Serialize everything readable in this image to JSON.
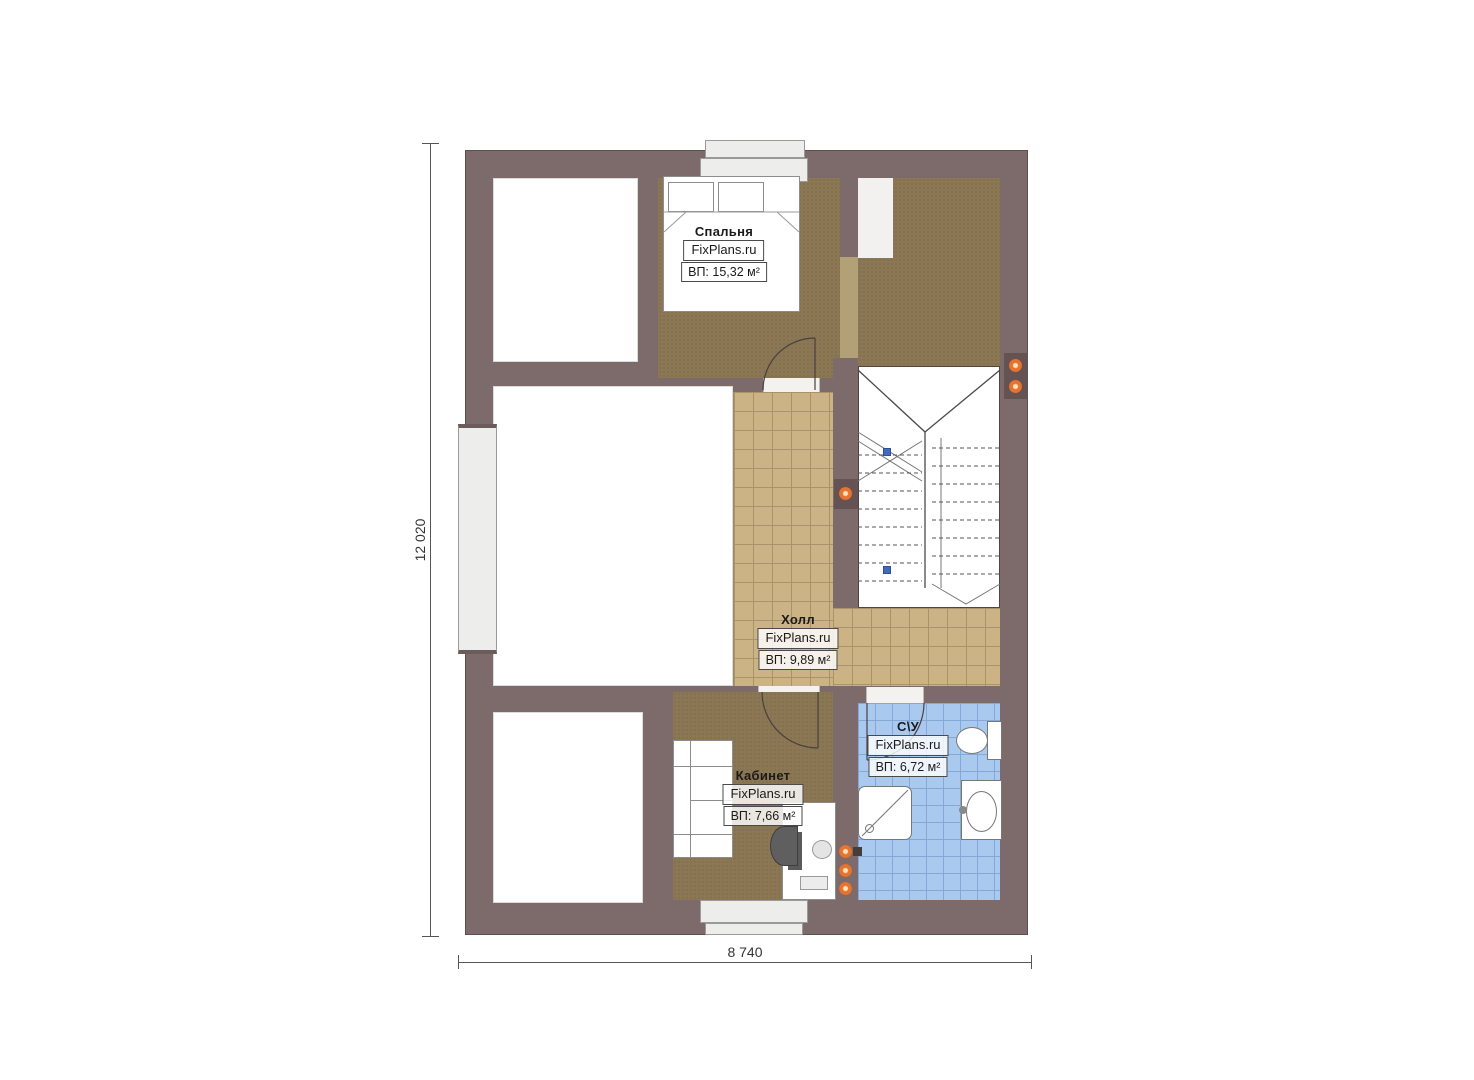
{
  "watermark": "FixPlans.ru",
  "rooms": {
    "bedroom": {
      "name": "Спальня",
      "watermark": "FixPlans.ru",
      "area": "ВП: 15,32 м²"
    },
    "hall": {
      "name": "Холл",
      "watermark": "FixPlans.ru",
      "area": "ВП: 9,89 м²"
    },
    "office": {
      "name": "Кабинет",
      "watermark": "FixPlans.ru",
      "area": "ВП: 7,66 м²"
    },
    "bathroom": {
      "name": "С\\У",
      "watermark": "FixPlans.ru",
      "area": "ВП: 6,72 м²"
    }
  },
  "dimensions": {
    "vertical": "12 020",
    "horizontal": "8 740"
  },
  "stairs": {
    "left_steps": 8,
    "right_steps": 8
  },
  "colors": {
    "wall": "#7d6b6b",
    "carpet": "#8b7754",
    "hall_tile": "#cbb386",
    "bath_tile": "#aac9ee",
    "accent_orange": "#e8732e",
    "marker_blue": "#3f6bc0"
  }
}
